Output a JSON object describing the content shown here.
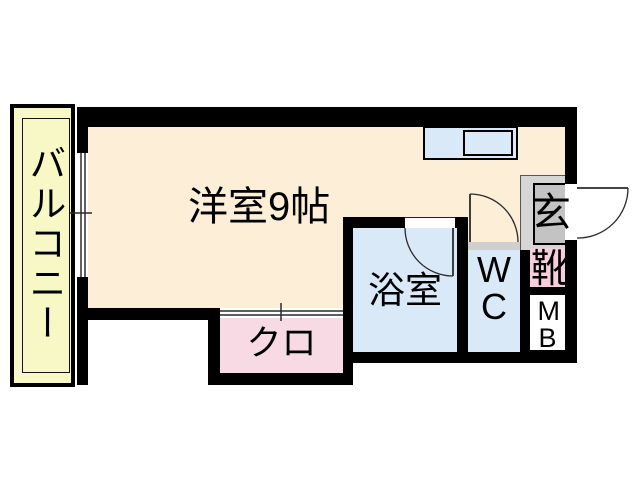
{
  "plan_title": "apartment-floor-plan",
  "rooms": {
    "balcony": {
      "label": "バルコニー"
    },
    "main_room": {
      "label": "洋室9帖"
    },
    "bath": {
      "label": "浴室"
    },
    "wc": {
      "label": "WC"
    },
    "closet": {
      "label": "クロ"
    },
    "genkan": {
      "label": "玄"
    },
    "shoe_box": {
      "label": "靴"
    },
    "meter_box": {
      "label": "MB"
    }
  },
  "colors": {
    "wall": "#000000",
    "balcony_fill": "#f8f8c6",
    "main_room_fill": "#fdeed8",
    "water_room_fill": "#d9e9f8",
    "closet_fill": "#f7dae3",
    "shoe_box_fill": "#f6cfdc",
    "genkan_surround_fill": "#d6d6d6",
    "genkan_fill": "#c3c3c3",
    "meter_box_fill": "#ffffff",
    "door_threshold_fill": "#cfcfcf",
    "door_line": "#2a2a2a"
  }
}
